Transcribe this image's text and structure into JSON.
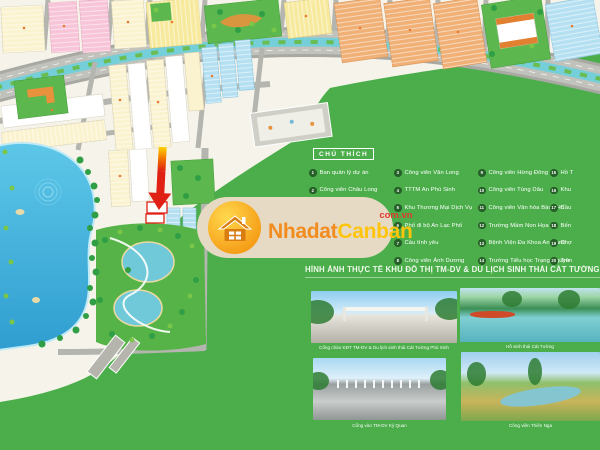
{
  "brand": {
    "name_part1": "Nhadat",
    "name_part2": "Canban",
    "domain": "com.vn"
  },
  "colors": {
    "panel_green": "#4bae4b",
    "accent_red": "#e02015",
    "brand_orange": "#f28c1e",
    "brand_yellow": "#ffc40c",
    "canal_cyan": "#74cfd8"
  },
  "legend": {
    "title": "CHÚ THÍCH",
    "columns": [
      {
        "items": [
          {
            "n": "1",
            "label": "Ban quản lý dự án"
          },
          {
            "n": "2",
            "label": "Công viên Châu Long"
          }
        ]
      },
      {
        "items": [
          {
            "n": "3",
            "label": "Công viên Văn Long"
          },
          {
            "n": "4",
            "label": "TTTM An Phú Sinh"
          },
          {
            "n": "5",
            "label": "Khu Thương Mại Dịch Vụ"
          },
          {
            "n": "6",
            "label": "Phố đi bộ An Lạc Phố"
          },
          {
            "n": "7",
            "label": "Cầu tình yêu"
          },
          {
            "n": "8",
            "label": "Công viên Ánh Dương"
          }
        ]
      },
      {
        "items": [
          {
            "n": "9",
            "label": "Công viên Hừng Đông"
          },
          {
            "n": "10",
            "label": "Công viên Tùng Dâu"
          },
          {
            "n": "11",
            "label": "Công viên Văn hóa Bách Hổ"
          },
          {
            "n": "12",
            "label": "Trường Mầm Non Họa Mi"
          },
          {
            "n": "13",
            "label": "Bệnh Viện Đa Khoa An Hạnh"
          },
          {
            "n": "14",
            "label": "Trường Tiểu học Trạng Nguyên"
          }
        ]
      },
      {
        "items": [
          {
            "n": "15",
            "label": "Hồ T"
          },
          {
            "n": "16",
            "label": "Khu"
          },
          {
            "n": "17",
            "label": "Cầu"
          },
          {
            "n": "18",
            "label": "Bến"
          },
          {
            "n": "19",
            "label": "Chợ"
          },
          {
            "n": "20",
            "label": "Trư"
          }
        ]
      }
    ]
  },
  "section": {
    "heading": "HÌNH ẢNH THỰC TẾ KHU ĐÔ THỊ TM-DV & DU LỊCH SINH THÁI CÁT TƯỜNG"
  },
  "photos": [
    {
      "caption": "Cổng chào KĐT TM-DV & Du lịch sinh thái Cát Tường Phú Sinh"
    },
    {
      "caption": "Hồ sinh thái Cát Tường"
    },
    {
      "caption": "Cổng vào TM-DV Kỳ Quan"
    },
    {
      "caption": "Công viên Thiên Nga"
    }
  ]
}
